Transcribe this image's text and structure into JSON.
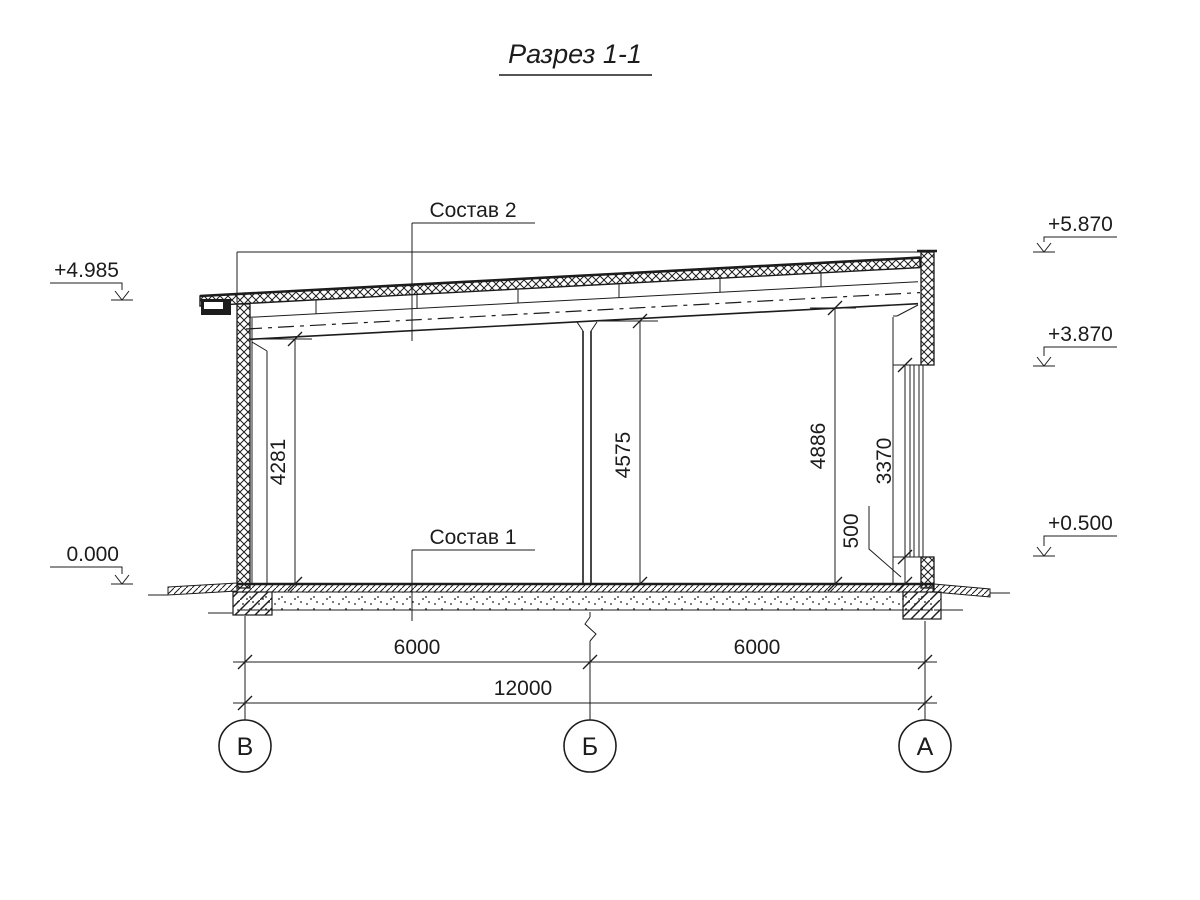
{
  "title": "Разрез 1-1",
  "section": {
    "callout_roof": "Состав 2",
    "callout_floor": "Состав 1"
  },
  "elevations": {
    "left_roof": "+4.985",
    "left_floor": "0.000",
    "right_parapet": "+5.870",
    "right_window_top": "+3.870",
    "right_sill": "+0.500"
  },
  "dimensions": {
    "vertical": {
      "left_clear_height": "4281",
      "middle_clear_height": "4575",
      "right_clear_height": "4886",
      "window_height": "3370",
      "sill_height": "500"
    },
    "horizontal": {
      "bay_left": "6000",
      "bay_right": "6000",
      "total": "12000"
    }
  },
  "grid_axes": {
    "left": "В",
    "middle": "Б",
    "right": "А"
  },
  "colors": {
    "ink": "#1c1c1c",
    "paper": "#ffffff"
  }
}
